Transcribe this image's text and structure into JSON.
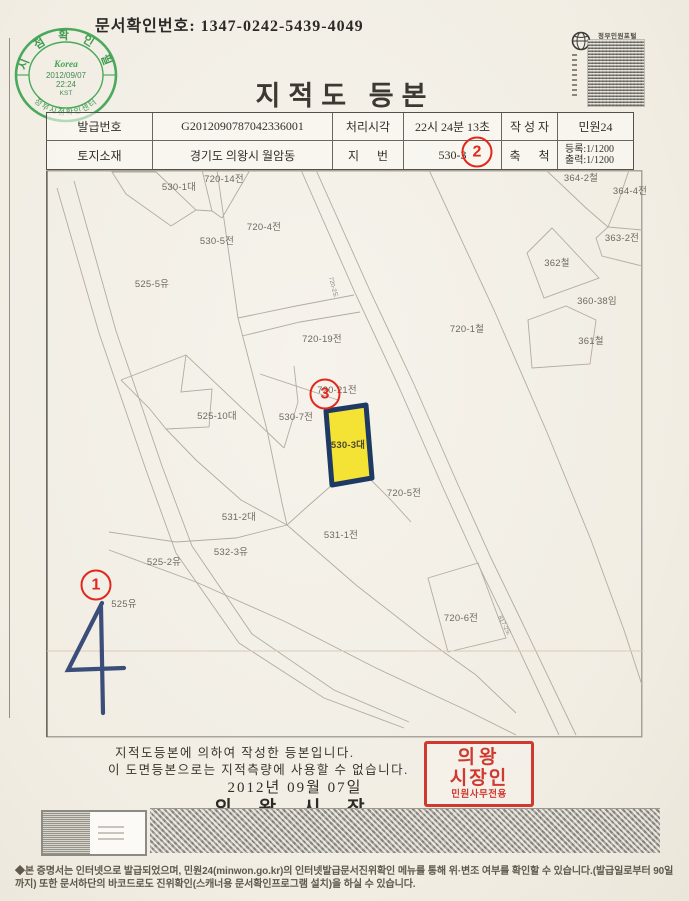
{
  "doc": {
    "confirm_label_and_number": "문서확인번호: 1347-0242-5439-4049",
    "title": "지적도 등본"
  },
  "verify_stamp": {
    "top_arc": "시 점 확 인 필",
    "brand": "Korea",
    "date": "2012/09/07",
    "time": "22:24",
    "tz": "KST",
    "bottom_arc": "정부시점확인센터",
    "color": "#3aa24f"
  },
  "portal_mark": {
    "label": "정부민원포털"
  },
  "info_table": {
    "r1c1_label": "발급번호",
    "r1c1_value": "G2012090787042336001",
    "r1c2_label": "처리시각",
    "r1c2_value": "22시 24분 13초",
    "r1c3_label": "작 성 자",
    "r1c3_value": "민원24",
    "r2c1_label": "토지소재",
    "r2c1_value": "경기도 의왕시 월암동",
    "r2c2_label": "지      번",
    "r2c2_value": "530-3",
    "r2c3_label": "축      척",
    "r2c3_value_line1": "등록:1/1200",
    "r2c3_value_line2": "출력:1/1200"
  },
  "map": {
    "highlight": {
      "parcel": "530-3대",
      "fill": "#f4e335",
      "border": "#1e3a64"
    },
    "parcels": [
      {
        "label": "720-14전",
        "x": 178,
        "y": 8
      },
      {
        "label": "530-1대",
        "x": 133,
        "y": 16
      },
      {
        "label": "720-4전",
        "x": 218,
        "y": 56
      },
      {
        "label": "530-5전",
        "x": 171,
        "y": 70
      },
      {
        "label": "525-5유",
        "x": 106,
        "y": 113
      },
      {
        "label": "720-1철",
        "x": 421,
        "y": 158
      },
      {
        "label": "720-19전",
        "x": 276,
        "y": 168
      },
      {
        "label": "720-21전",
        "x": 291,
        "y": 219
      },
      {
        "label": "530-7전",
        "x": 250,
        "y": 246
      },
      {
        "label": "525-10대",
        "x": 171,
        "y": 245
      },
      {
        "label": "530-3대",
        "x": 302,
        "y": 274,
        "highlight": true
      },
      {
        "label": "720-5전",
        "x": 358,
        "y": 322
      },
      {
        "label": "531-2대",
        "x": 193,
        "y": 346
      },
      {
        "label": "531-1전",
        "x": 295,
        "y": 364
      },
      {
        "label": "532-3유",
        "x": 185,
        "y": 381
      },
      {
        "label": "525-2유",
        "x": 118,
        "y": 391
      },
      {
        "label": "525유",
        "x": 78,
        "y": 433
      },
      {
        "label": "720-6전",
        "x": 415,
        "y": 447
      },
      {
        "label": "364-2철",
        "x": 535,
        "y": 7
      },
      {
        "label": "364-4전",
        "x": 584,
        "y": 20
      },
      {
        "label": "363-2전",
        "x": 576,
        "y": 67
      },
      {
        "label": "362철",
        "x": 511,
        "y": 92
      },
      {
        "label": "360-38임",
        "x": 551,
        "y": 130
      },
      {
        "label": "361철",
        "x": 545,
        "y": 170
      }
    ],
    "road_labels": [
      {
        "label": "720-2도",
        "x": 288,
        "y": 117,
        "rot": 76
      },
      {
        "label": "817-2도",
        "x": 459,
        "y": 455,
        "rot": 63
      }
    ],
    "annotations": [
      {
        "label": "1",
        "x": 96,
        "y": 585
      },
      {
        "label": "2",
        "x": 477,
        "y": 152
      },
      {
        "label": "3",
        "x": 325,
        "y": 394
      }
    ],
    "handwritten_mark": "4"
  },
  "certificate": {
    "line1": "지적도등본에 의하여 작성한 등본입니다.",
    "line2": "이 도면등본으로는 지적측량에 사용할 수 없습니다.",
    "date": "2012년 09월 07일",
    "issuer": "의 왕 시 장",
    "seal_line1": "의왕",
    "seal_line2": "시장인",
    "seal_line3": "민원사무전용",
    "seal_color": "#cf3a30"
  },
  "footer": {
    "text": "◆본 증명서는 인터넷으로 발급되었으며, 민원24(minwon.go.kr)의 인터넷발급문서진위확인 메뉴를 통해 위·변조 여부를 확인할 수 있습니다.(발급일로부터 90일까지) 또한 문서하단의 바코드로도 진위확인(스캐너용 문서확인프로그램 설치)을 하실 수 있습니다."
  }
}
